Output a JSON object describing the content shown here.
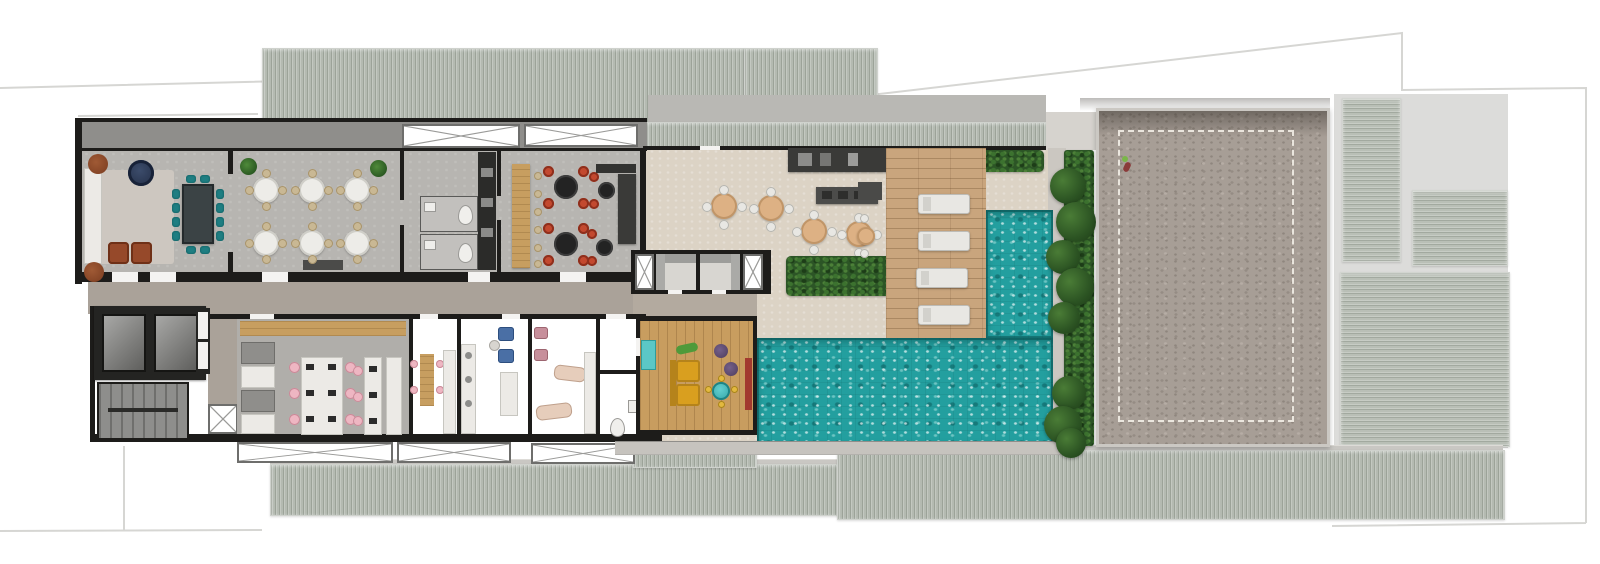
{
  "scene": {
    "kind": "architectural floor plan render (rooftop amenities level), top-down view",
    "width_px": 1600,
    "height_px": 564,
    "background": "#ffffff",
    "visible_text": "none"
  },
  "palette": {
    "wall": "#1d1c1a",
    "indoor_floor": "#b7b5b1",
    "corridor_floor": "#aaa299",
    "terrace_floor": "#dcd3c5",
    "concrete_walkway": "#8f8e8b",
    "roof_striped": "#b4bab1",
    "court_surface": "#a79e96",
    "court_marking_dashed": "#f5f1ea",
    "pool_water": "#239f9f",
    "wood_deck": "#c9a57d",
    "wood_floor": "#c89d5f",
    "hedge_green": "#2c5526",
    "lounger_white": "#e8e7e3",
    "chair_red": "#c3492f",
    "chair_teal": "#1f7e82",
    "chair_pink": "#eeb6c2",
    "chair_blue": "#4a6fa5",
    "chair_beige": "#c9b894",
    "table_tan": "#ddb184",
    "sofa_yellow": "#d99f1f",
    "armchair_brown": "#96492a",
    "navy_table": "#2b3850",
    "bench_red": "#a23a2f",
    "pouf_purple": "#5f4a6d"
  },
  "zones": [
    {
      "id": "lounge",
      "desc": "lounge: white sofa, rug, navy round table, 2 round + 2 square brown armchairs"
    },
    {
      "id": "meeting-area",
      "desc": "long dark table with 12 teal chairs"
    },
    {
      "id": "dining-room",
      "desc": "6 round white tables, 4 beige chairs each, 2 plants, dark sideboard"
    },
    {
      "id": "restrooms",
      "desc": "two WC stalls with toilets beside dark service galley"
    },
    {
      "id": "games-bar",
      "desc": "wood high table with 6 stools, 2 black tables with 4 red chairs each, 2 side tables with 2 red chairs each, dark counter"
    },
    {
      "id": "sauna-cabins",
      "desc": "two bench cabins between X-marked shafts"
    },
    {
      "id": "corridor",
      "desc": "central hallway linking both room rows"
    },
    {
      "id": "elevator-core",
      "desc": "2 elevators, service shafts, stairwell, X shaft"
    },
    {
      "id": "coworking",
      "desc": "wood counter, cabinets, desk island with monitors and 6 pink chairs, side desk with 3 pink chairs"
    },
    {
      "id": "craft-room",
      "desc": "wood table with 4 pink stools and shelving"
    },
    {
      "id": "salon",
      "desc": "2 blue armchairs, side table, cabinet"
    },
    {
      "id": "spa",
      "desc": "2 rose chairs and 2 massage beds with counter"
    },
    {
      "id": "wc-small",
      "desc": "toilet and washbasin"
    },
    {
      "id": "kids-playroom",
      "desc": "wood floor, yellow sofa, teal kids table with 4 stools, 2 purple poufs, toy, red bench, teal cabinet"
    },
    {
      "id": "gourmet-terrace",
      "desc": "4 tan round tables with 4 white chairs each, BBQ counter, dark island, side table, planter bed"
    },
    {
      "id": "sun-deck",
      "desc": "timber deck with 4 white sun loungers"
    },
    {
      "id": "lap-pool",
      "desc": "narrow pool arm joining main pool"
    },
    {
      "id": "main-pool",
      "desc": "large sparkling pool with stone apron"
    },
    {
      "id": "sports-court",
      "desc": "speckled concrete court, dashed white perimeter line, one person figure"
    },
    {
      "id": "roofs",
      "desc": "striped metal roof bands (top, bottom) and right-side roof panels"
    },
    {
      "id": "lot-boundary",
      "desc": "thin light-gray property outline"
    }
  ],
  "counts": {
    "dining_tables": 6,
    "dining_chairs": 24,
    "meeting_chairs_teal": 12,
    "red_chairs": 12,
    "terrace_tables": 4,
    "terrace_chairs_white": 16,
    "sun_loungers": 4,
    "elevators": 2,
    "pools": 2,
    "coworking_monitors": 9,
    "coworking_chairs_pink": 9,
    "massage_beds": 2,
    "sauna_cabins": 2,
    "people_on_court": 1
  }
}
